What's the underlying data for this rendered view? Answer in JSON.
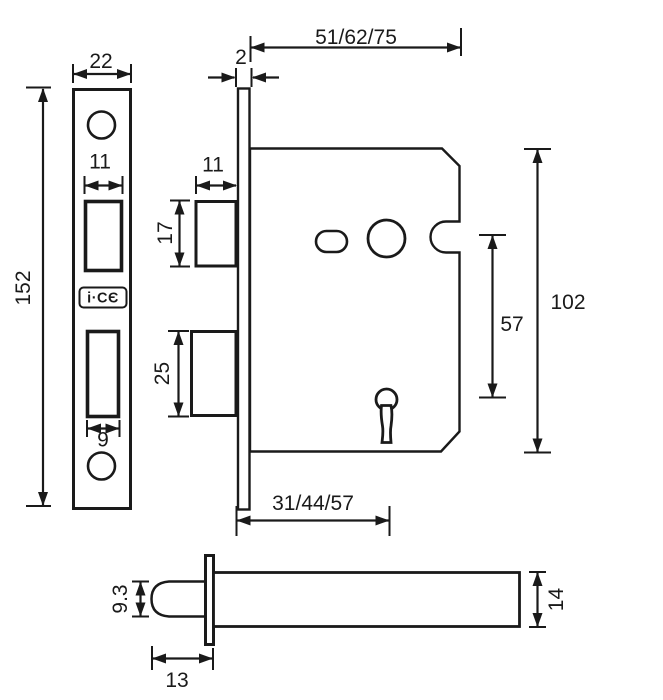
{
  "colors": {
    "ink": "#1a1a1a",
    "paper": "#ffffff"
  },
  "logo": {
    "text": "i·CЄ"
  },
  "dimensions": {
    "faceplate_front": {
      "plate_width": "22",
      "plate_height": "152",
      "latch_cutout_width": "11",
      "deadbolt_cutout_width": "9"
    },
    "lock_case_side": {
      "faceplate_thickness": "2",
      "case_depth_options": "51/62/75",
      "latch_bolt_width": "11",
      "latch_bolt_height": "17",
      "deadbolt_height": "25",
      "follower_to_keyhole_centre": "57",
      "case_height": "102",
      "backset_options": "31/44/57"
    },
    "latchbolt_detail": {
      "bolt_height": "9.3",
      "bolt_nose_length": "13",
      "bar_height": "14"
    }
  }
}
